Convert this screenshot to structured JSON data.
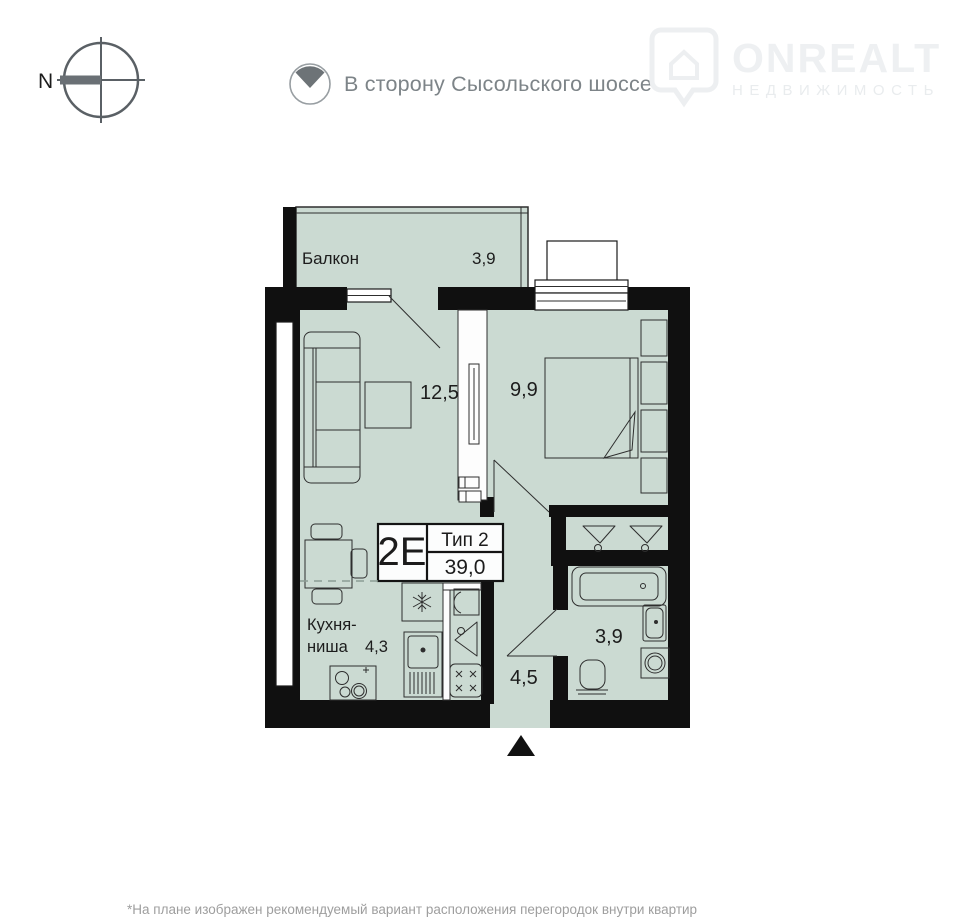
{
  "colors": {
    "room_fill": "#cbdad2",
    "wall": "#101010",
    "furniture_line": "#2e2e2e",
    "header_text": "#7d8488",
    "compass_gray": "#6a7075",
    "watermark_brand": "#eef0f2",
    "watermark_tagline": "#e9ecee",
    "dashed_line": "#8b9c94",
    "label_text": "#1c1c1c"
  },
  "header": {
    "north_label": "N",
    "direction_text": "В сторону Сысольского шоссе",
    "watermark": {
      "brand": "ONREALT",
      "tagline": "НЕДВИЖИМОСТЬ"
    }
  },
  "plan": {
    "balcony": {
      "name": "Балкон",
      "area": "3,9"
    },
    "living": {
      "area": "12,5"
    },
    "bedroom": {
      "area": "9,9"
    },
    "kitchen": {
      "name_line1": "Кухня-",
      "name_line2": "ниша",
      "area": "4,3"
    },
    "hall": {
      "area": "4,5"
    },
    "bathroom": {
      "area": "3,9"
    },
    "unit": {
      "code": "2Е",
      "type": "Тип 2",
      "total_area": "39,0"
    }
  },
  "footer": {
    "disclaimer": "*На плане изображен рекомендуемый вариант расположения перегородок внутри квартир"
  }
}
